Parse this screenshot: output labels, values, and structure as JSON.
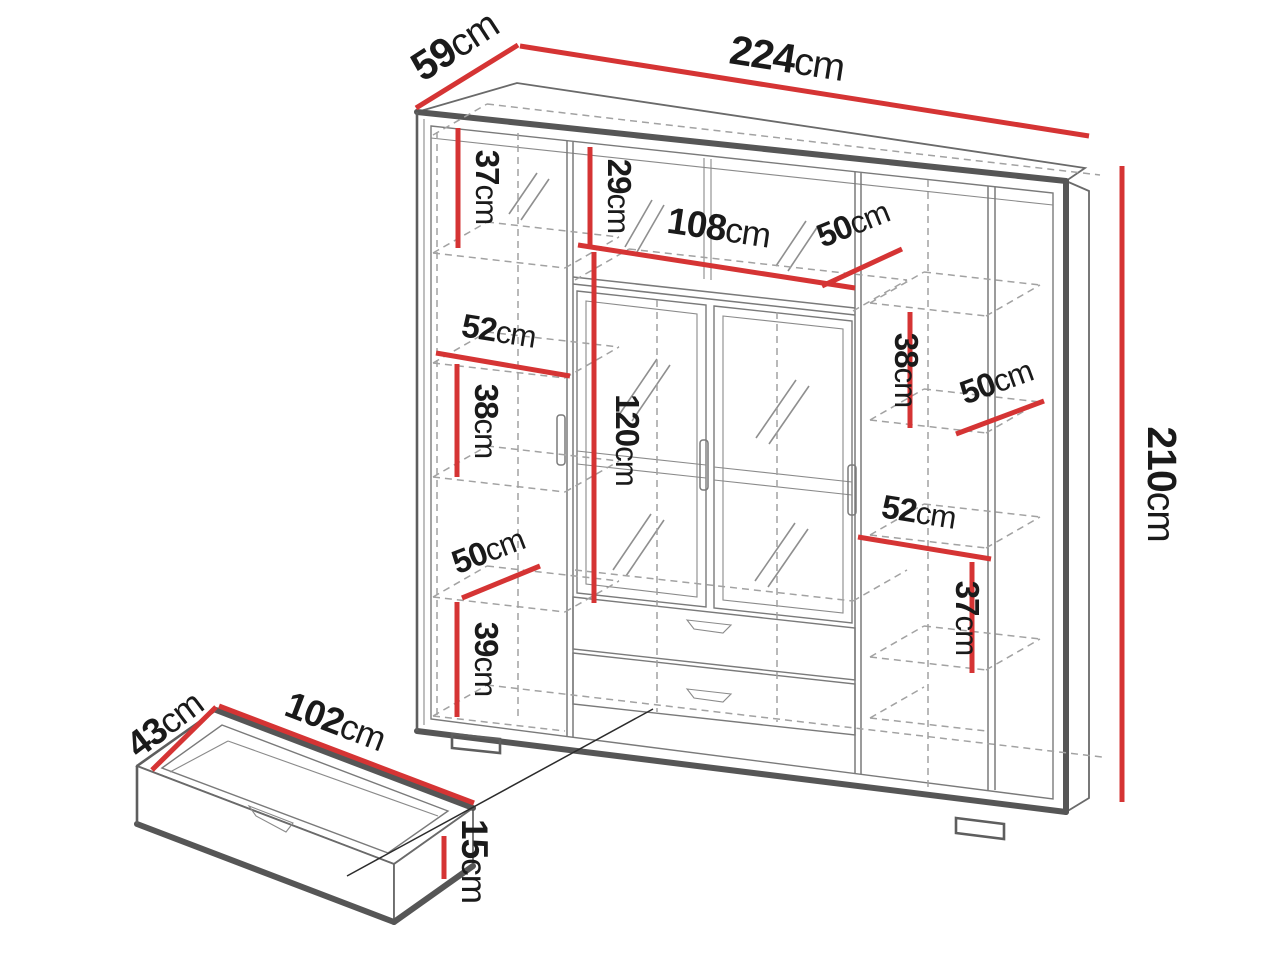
{
  "diagram": {
    "subject": "wardrobe dimension diagram",
    "accent_color": "#d53434",
    "outline_color": "#565656",
    "dashed_color": "#a2a2a2",
    "label_color": "#1a1a1a",
    "background_color": "#ffffff"
  },
  "unit_label": "cm",
  "wardrobe": {
    "width": "224",
    "depth": "59",
    "height": "210",
    "left_column": {
      "top_shelf_height": "37",
      "shelf_width": "52",
      "middle_shelf_height": "38",
      "lower_shelf_depth": "50",
      "bottom_shelf_height": "39"
    },
    "center_section": {
      "top_shelf_height": "29",
      "opening_width": "108",
      "top_shelf_depth": "50",
      "door_height": "120"
    },
    "right_column": {
      "middle_shelf_height": "38",
      "shelf_depth": "50",
      "shelf_width": "52",
      "lower_shelf_height": "37"
    }
  },
  "drawer": {
    "width": "102",
    "depth": "43",
    "height": "15"
  }
}
